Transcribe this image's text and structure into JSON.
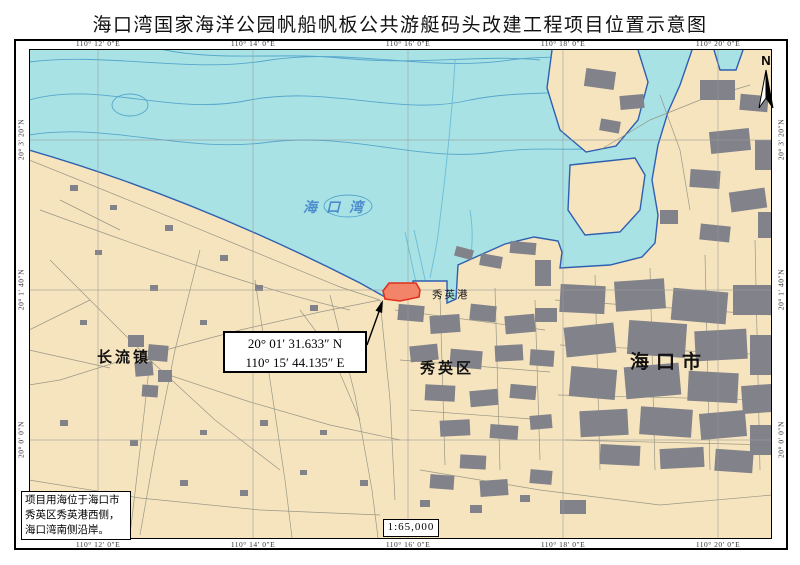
{
  "title": "海口湾国家海洋公园帆船帆板公共游艇码头改建工程项目位置示意图",
  "map": {
    "grid": {
      "top_labels": [
        "110° 12′ 0″E",
        "110° 14′ 0″E",
        "110° 16′ 0″E",
        "110° 18′ 0″E",
        "110° 20′ 0″E"
      ],
      "bottom_labels": [
        "110° 12′ 0″E",
        "110° 14′ 0″E",
        "110° 16′ 0″E",
        "110° 18′ 0″E",
        "110° 20′ 0″E"
      ],
      "left_labels": [
        "20° 3′ 20″N",
        "20° 1′ 40″N",
        "20° 0′ 0″N"
      ],
      "right_labels": [
        "20° 3′ 20″N",
        "20° 1′ 40″N",
        "20° 0′ 0″N"
      ]
    },
    "labels": {
      "sea": "海口湾",
      "port": "秀英港",
      "district": "秀英区",
      "town": "长流镇",
      "city": "海口市"
    },
    "callout": {
      "line1": "20° 01′ 31.633″ N",
      "line2": "110° 15′ 44.135″ E"
    },
    "note": {
      "line1": "项目用海位于海口市",
      "line2": "秀英区秀英港西侧，",
      "line3": "海口湾南侧沿岸。"
    },
    "scale": "1:65,000",
    "north": "N",
    "colors": {
      "sea": "#A9E2E5",
      "land": "#F6E4BE",
      "urban": "#82828A",
      "coast": "#2E5FB0",
      "contour": "#56A6CC",
      "channel": "#6FC0D8",
      "road": "#8F8F80",
      "grid": "#9A9A9A",
      "project_fill": "#F28469",
      "project_stroke": "#E0301E",
      "sea_label": "#3C7EC8"
    }
  }
}
